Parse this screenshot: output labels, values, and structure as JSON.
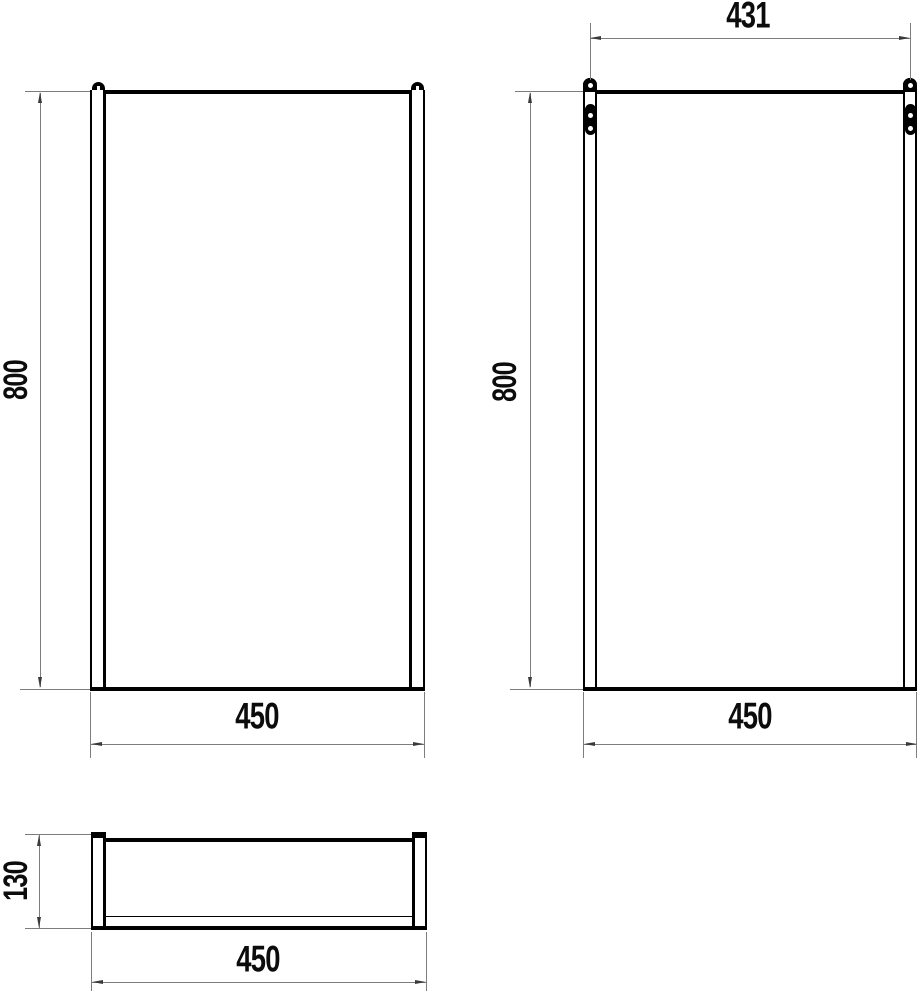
{
  "drawing": {
    "type": "technical-dimension-drawing",
    "colors": {
      "object_line": "#000000",
      "dimension_line": "#7d7d7d",
      "label": "#0c0c0c",
      "background": "#ffffff"
    },
    "front_view": {
      "height": "800",
      "width": "450",
      "icons": {
        "left_hanger": "hanger-loop-icon",
        "right_hanger": "hanger-loop-icon"
      }
    },
    "side_view": {
      "mount_spacing": "431",
      "height": "800",
      "width": "450",
      "icons": {
        "left_bracket": "wall-bracket-icon",
        "right_bracket": "wall-bracket-icon"
      }
    },
    "top_view": {
      "depth": "130",
      "width": "450"
    }
  }
}
